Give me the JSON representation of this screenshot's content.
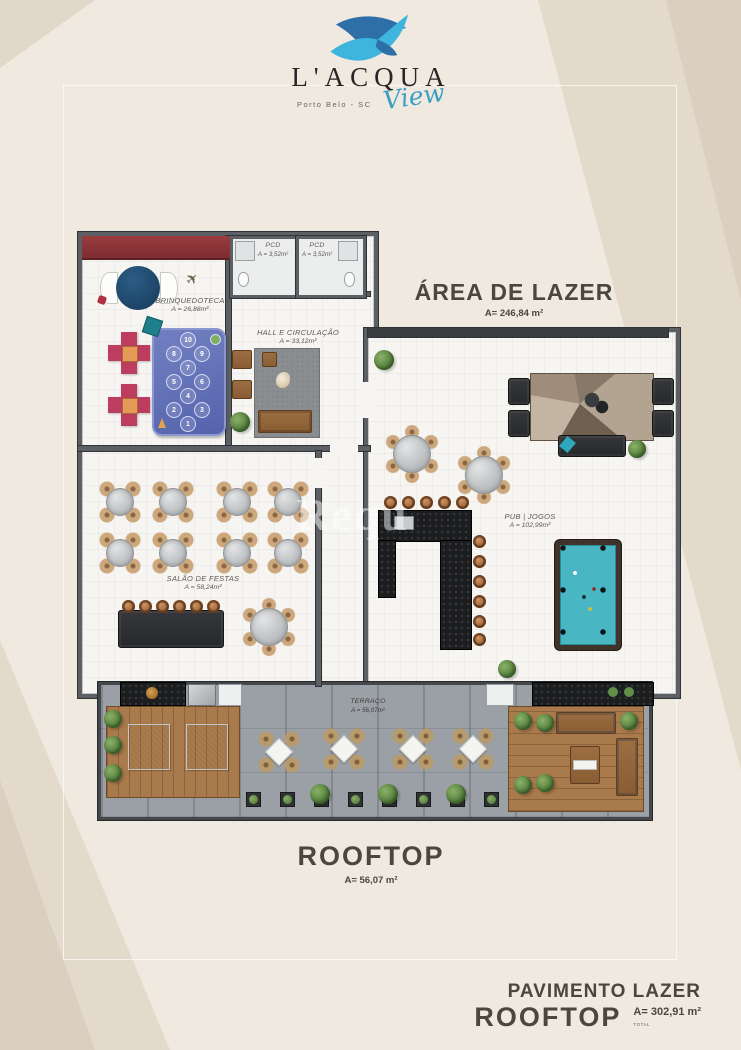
{
  "logo": {
    "name": "L'ACQUA",
    "script": "View",
    "location": "Porto Belo - SC"
  },
  "lazer": {
    "title": "ÁREA DE LAZER",
    "area": "A= 246,84 m²"
  },
  "rooms": {
    "brinquedoteca": {
      "label": "BRINQUEDOTECA",
      "area": "A = 26,88m²",
      "rug_numbers": [
        "1",
        "2",
        "3",
        "4",
        "5",
        "6",
        "7",
        "8",
        "9",
        "10"
      ]
    },
    "pcd1": {
      "label": "PCD",
      "area": "A = 3,52m²"
    },
    "pcd2": {
      "label": "PCD",
      "area": "A = 3,52m²"
    },
    "hall": {
      "label": "HALL E CIRCULAÇÃO",
      "area": "A = 33,12m²"
    },
    "salao": {
      "label": "SALÃO DE FESTAS",
      "area": "A = 58,24m²"
    },
    "pub": {
      "label": "PUB | JOGOS",
      "area": "A = 102,99m²"
    },
    "terraco": {
      "label": "TERRAÇO",
      "area": "A = 56,07m²"
    }
  },
  "rooftop": {
    "title": "ROOFTOP",
    "area": "A= 56,07 m²"
  },
  "footer": {
    "line1": "PAVIMENTO LAZER",
    "line2": "ROOFTOP",
    "area": "A= 302,91 m²",
    "note": "TOTAL"
  },
  "watermark": {
    "text": "Requ"
  },
  "colors": {
    "logo_dark_blue": "#2f6fa8",
    "logo_cyan": "#3db5dc",
    "accent_red": "#8e3538",
    "pool_teal": "#49b6c4",
    "background": "#efe9e0"
  }
}
